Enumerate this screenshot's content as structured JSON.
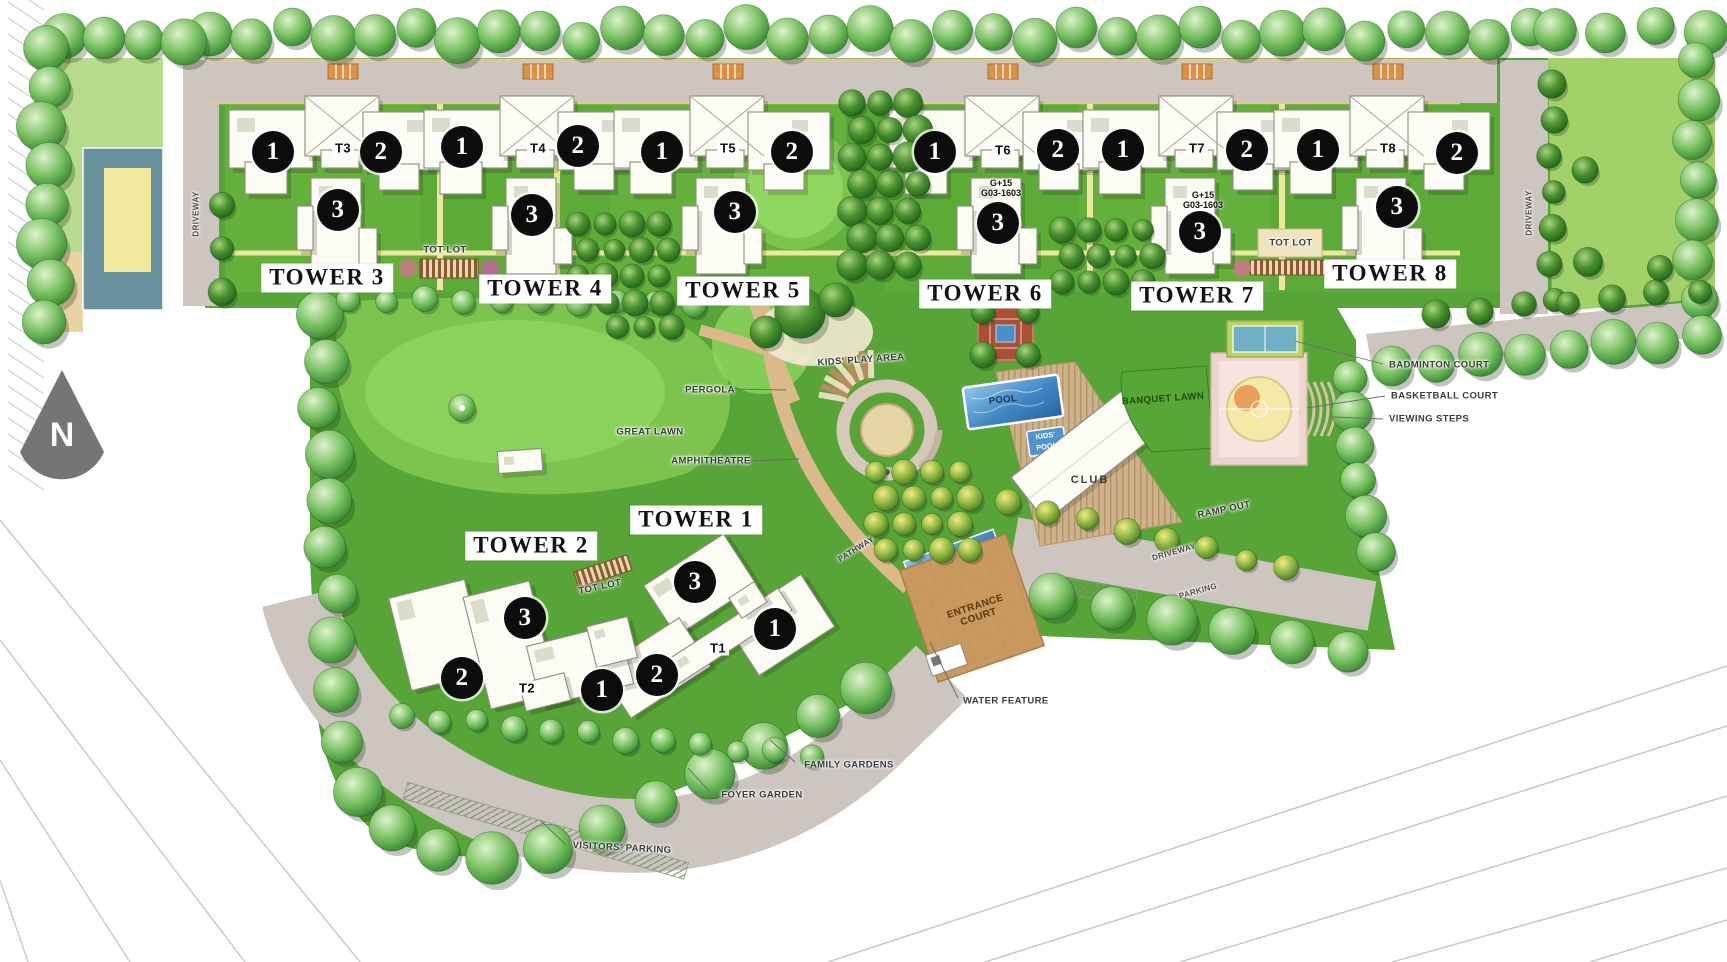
{
  "palette": {
    "site_green": "#57a437",
    "panel_green": "#63b13b",
    "lawn_light": "#8fd75f",
    "lawn_mid": "#7cc44e",
    "road": "#cdc5c0",
    "road_edge": "#e3c69c",
    "path_yellow": "#efe7a0",
    "path_tan": "#dcb98b",
    "pool_blue": "#4187c4",
    "court_pink": "#eed6d0",
    "court_yellow": "#f6e9a8",
    "badminton_blue": "#6fb0c6",
    "deck_tan": "#cdb28a",
    "entrance_tan": "#c9995f",
    "teal_court": "#68929c",
    "cream_building": "#f2efc3",
    "building": "#fcfcf4",
    "bldg_stroke": "#8d8d80"
  },
  "compass": {
    "north_label": "N"
  },
  "towers": [
    {
      "name": "TOWER 1",
      "code": "T1"
    },
    {
      "name": "TOWER 2",
      "code": "T2"
    },
    {
      "name": "TOWER 3",
      "code": "T3"
    },
    {
      "name": "TOWER 4",
      "code": "T4"
    },
    {
      "name": "TOWER 5",
      "code": "T5"
    },
    {
      "name": "TOWER 6",
      "code": "T6"
    },
    {
      "name": "TOWER 7",
      "code": "T7"
    },
    {
      "name": "TOWER 8",
      "code": "T8"
    }
  ],
  "unit_markers": [
    "1",
    "2",
    "3"
  ],
  "tower_note": {
    "line1": "G+15",
    "line2": "G03-1603"
  },
  "labels": {
    "driveway": "DRIVEWAY",
    "parking": "PARKING",
    "tot_lot": "TOT LOT",
    "kids_play_area": "KIDS' PLAY AREA",
    "pergola": "PERGOLA",
    "great_lawn": "GREAT LAWN",
    "amphitheatre": "AMPHITHEATRE",
    "pool": "POOL",
    "kids_pool": "KIDS' POOL",
    "club": "CLUB",
    "banquet_lawn": "BANQUET LAWN",
    "ramp_out": "RAMP OUT",
    "badminton_court": "BADMINTON COURT",
    "basketball_court": "BASKETBALL COURT",
    "viewing_steps": "VIEWING STEPS",
    "entrance_court": "ENTRANCE COURT",
    "water_feature": "WATER FEATURE",
    "pathway": "PATHWAY",
    "family_gardens": "FAMILY GARDENS",
    "foyer_garden": "FOYER GARDEN",
    "visitors_parking": "VISITORS' PARKING"
  }
}
